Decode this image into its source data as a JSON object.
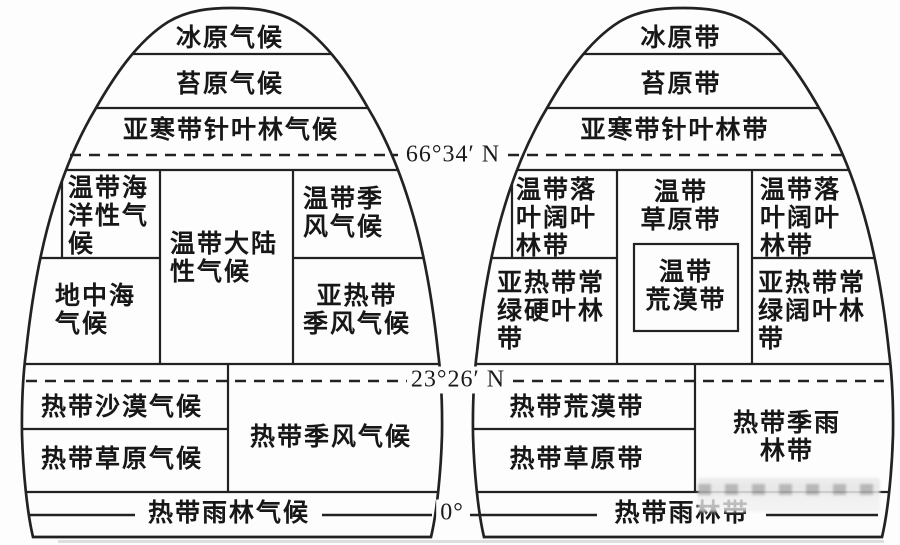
{
  "latitudes": {
    "arctic_circle": "66°34′ N",
    "tropic_of_cancer": "23°26′ N",
    "equator": "0°"
  },
  "climate_dome": {
    "zones": {
      "ice_cap": "冰原气候",
      "tundra": "苔原气候",
      "subarctic_coniferous": "亚寒带针叶林气候",
      "temperate_oceanic": "温带海\n洋性气\n候",
      "temperate_continental": "温带大陆\n性气候",
      "temperate_monsoon": "温带季\n风气候",
      "mediterranean": "地中海\n气候",
      "subtropical_monsoon": "亚热带\n季风气候",
      "tropical_desert": "热带沙漠气候",
      "tropical_savanna": "热带草原气候",
      "tropical_monsoon": "热带季风气候",
      "tropical_rainforest": "热带雨林气候"
    }
  },
  "belt_dome": {
    "zones": {
      "ice_cap": "冰原带",
      "tundra": "苔原带",
      "subarctic_coniferous": "亚寒带针叶林带",
      "deciduous_broadleaf_west": "温带落\n叶阔叶\n林带",
      "temperate_grassland": "温带\n草原带",
      "deciduous_broadleaf_east": "温带落\n叶阔叶\n林带",
      "sclerophyllous_forest": "亚热带常\n绿硬叶林\n带",
      "temperate_desert": "温带\n荒漠带",
      "evergreen_broadleaf_forest": "亚热带常\n绿阔叶林\n带",
      "tropical_desert": "热带荒漠带",
      "tropical_grassland": "热带草原带",
      "tropical_seasonal_rainforest": "热带季雨林带",
      "tropical_rainforest": "热带雨林带"
    }
  },
  "colors": {
    "line": "#222222",
    "text": "#171717",
    "background": "#fdfdfd"
  }
}
